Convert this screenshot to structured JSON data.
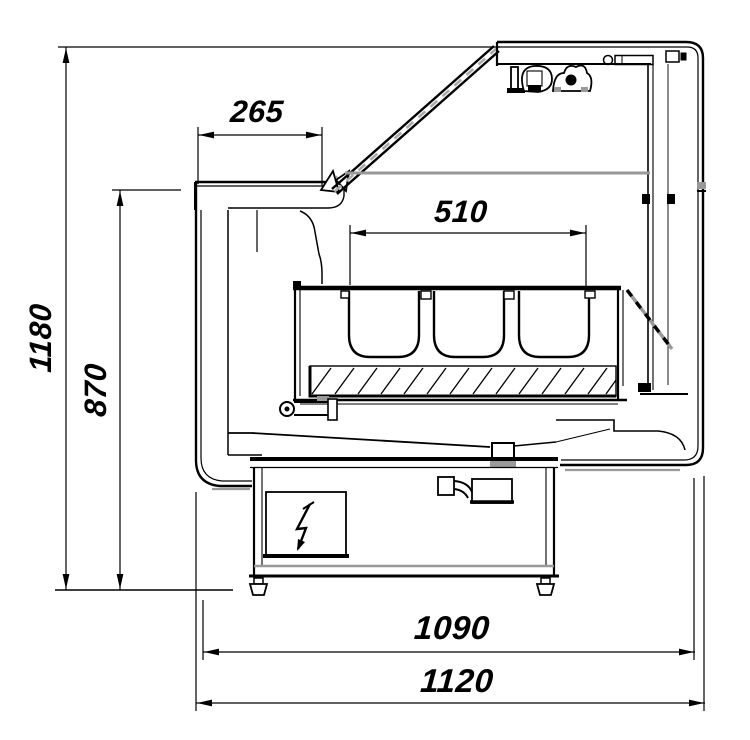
{
  "drawing": {
    "dimension_labels": [
      {
        "id": "265",
        "label": "265",
        "orientation": "horizontal"
      },
      {
        "id": "510",
        "label": "510",
        "orientation": "horizontal"
      },
      {
        "id": "1180",
        "label": "1180",
        "orientation": "vertical"
      },
      {
        "id": "870",
        "label": "870",
        "orientation": "vertical"
      },
      {
        "id": "1090",
        "label": "1090",
        "orientation": "horizontal"
      },
      {
        "id": "1120",
        "label": "1120",
        "orientation": "horizontal"
      }
    ],
    "symbols": [
      {
        "name": "lightning-bolt-icon",
        "glyph": "⚡"
      }
    ],
    "colors": {
      "line": "#000000",
      "gray_accent": "#999999",
      "background": "#ffffff"
    }
  }
}
